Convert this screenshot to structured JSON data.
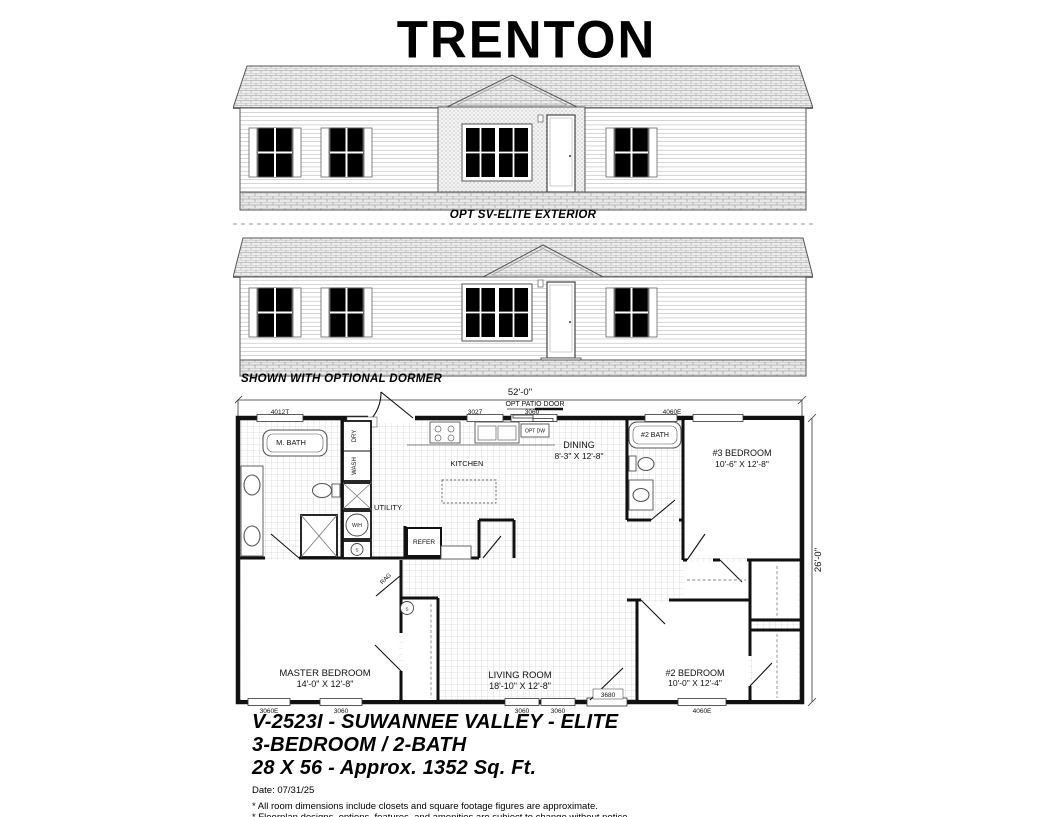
{
  "title": "TRENTON",
  "elevations": {
    "first_caption": "OPT SV-ELITE EXTERIOR",
    "second_caption": "SHOWN WITH OPTIONAL DORMER"
  },
  "floorplan": {
    "overall_width": "52'-0\"",
    "overall_depth": "26'-0\"",
    "opt_patio_door": "OPT PATIO DOOR",
    "top_labels": {
      "w1": "4012T",
      "door": "3680",
      "w2": "3027",
      "w3": "3060",
      "w4": "4060E"
    },
    "bottom_labels": {
      "w1": "3060E",
      "w2": "3060",
      "w3": "3060",
      "w4": "3060",
      "door": "3680",
      "w5": "4060E"
    },
    "rooms": {
      "m_bath": "M. BATH",
      "utility": "UTILITY",
      "kitchen": "KITCHEN",
      "dining_name": "DINING",
      "dining_size": "8'-3\" X 12'-8\"",
      "bath2": "#2 BATH",
      "bed3_name": "#3 BEDROOM",
      "bed3_size": "10'-6\" X 12'-8\"",
      "master_name": "MASTER BEDROOM",
      "master_size": "14'-0\" X 12'-8\"",
      "living_name": "LIVING ROOM",
      "living_size": "18'-10\" X 12'-8\"",
      "bed2_name": "#2 BEDROOM",
      "bed2_size": "10'-0\" X 12'-4\""
    },
    "fixtures": {
      "dry": "DRY",
      "wash": "WASH",
      "wh": "W/H",
      "smoke": "S",
      "refer": "REFER",
      "opt_dw": "OPT DW",
      "rag": "RAG"
    }
  },
  "footer": {
    "model": "V-2523I - SUWANNEE VALLEY - ELITE",
    "beds_baths": "3-BEDROOM / 2-BATH",
    "size": "28 X 56 - Approx. 1352 Sq. Ft.",
    "date": "Date: 07/31/25",
    "note1": "* All room dimensions include closets and square footage figures are approximate.",
    "note2": "* Floorplan designs, options, features, and amenities are subject to change without notice."
  }
}
